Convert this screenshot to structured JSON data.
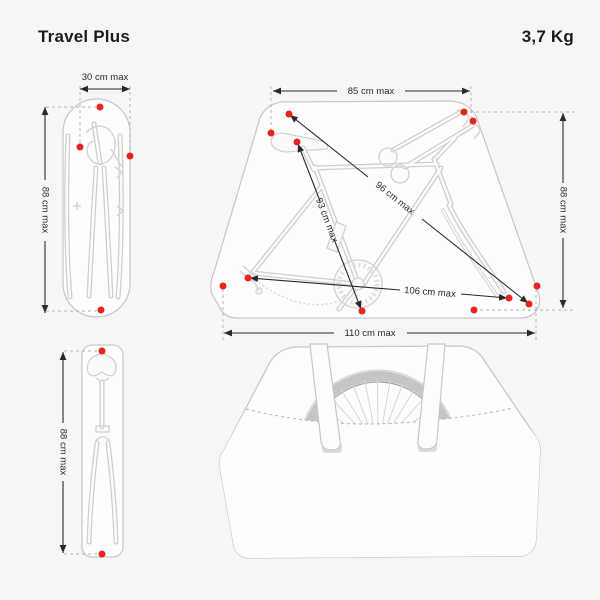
{
  "header": {
    "title": "Travel Plus",
    "weight": "3,7 Kg"
  },
  "colors": {
    "background": "#f6f6f4",
    "strap_point_red": "#e8241c",
    "dimension_line": "#2a2a2a",
    "bag_outline": "#c9c9c9",
    "bike_artwork": "#d6d6d6"
  },
  "views": {
    "folded_frame_view": {
      "width": "30 cm max",
      "height": "88 cm max"
    },
    "saddle_fork_view": {
      "height": "88 cm max"
    },
    "open_bag_view": {
      "top_width": "85 cm max",
      "height": "88 cm max",
      "bottom_width": "110 cm max",
      "diagonal_frame": "96 cm max",
      "diagonal_seat_to_crank": "93 cm max",
      "diagonal_derailleur_to_fork": "106 cm max"
    }
  }
}
